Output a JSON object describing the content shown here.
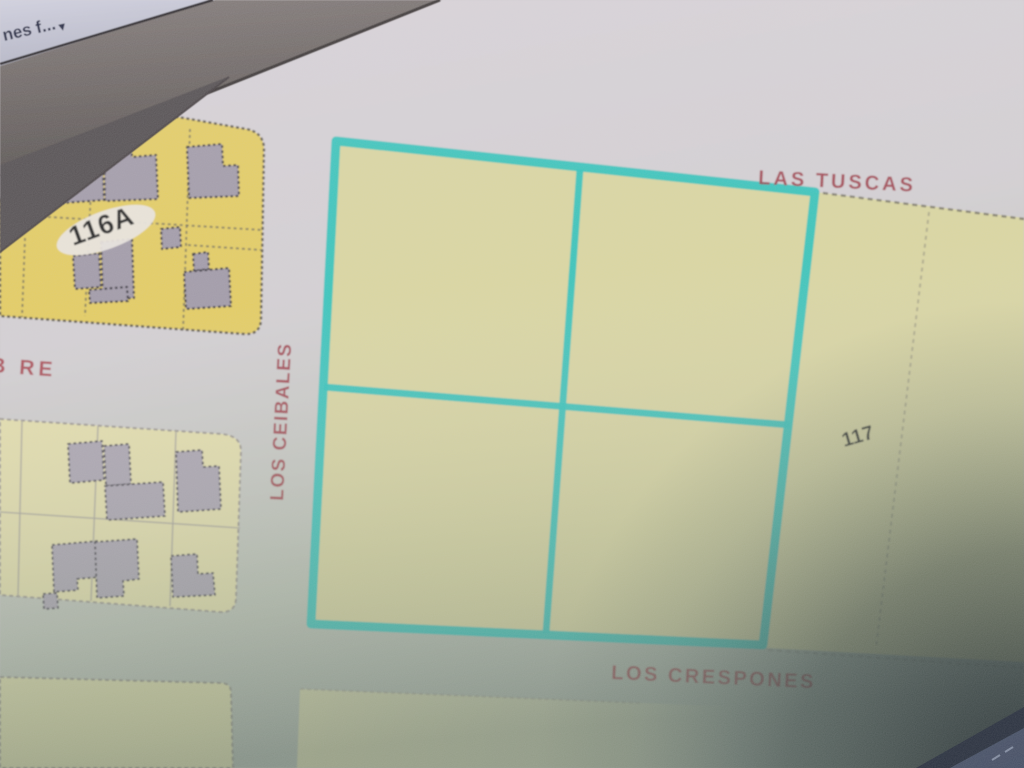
{
  "browser_chrome": {
    "tab_label": "nes f...",
    "icons": {
      "tab_dropdown": "▾"
    }
  },
  "map": {
    "street_labels": {
      "top": "LAS TUSCAS",
      "west_vertical": "LOS CEIBALES",
      "bottom": "LOS CRESPONES",
      "left_partial": "B RE"
    },
    "block_labels": {
      "west_block": "116A",
      "east_block": "117"
    },
    "selection_note": "four parcels outlined in cyan (2x2 grid)"
  },
  "colors": {
    "highlight": "#2fc4bc",
    "street-label": "#9d3541",
    "street-label-strong": "#a63944",
    "block-yellow-bright": "#e5cd60",
    "block-yellow-pale": "#e9e3ab",
    "parcel-pale": "#dbd7a0",
    "building-gray": "#a19aa8",
    "street-gray": "#d7d1d6",
    "label-black": "#1c1c1c",
    "bezel-dark": "#6e6663",
    "tab-strip": "#c7c7d5"
  }
}
